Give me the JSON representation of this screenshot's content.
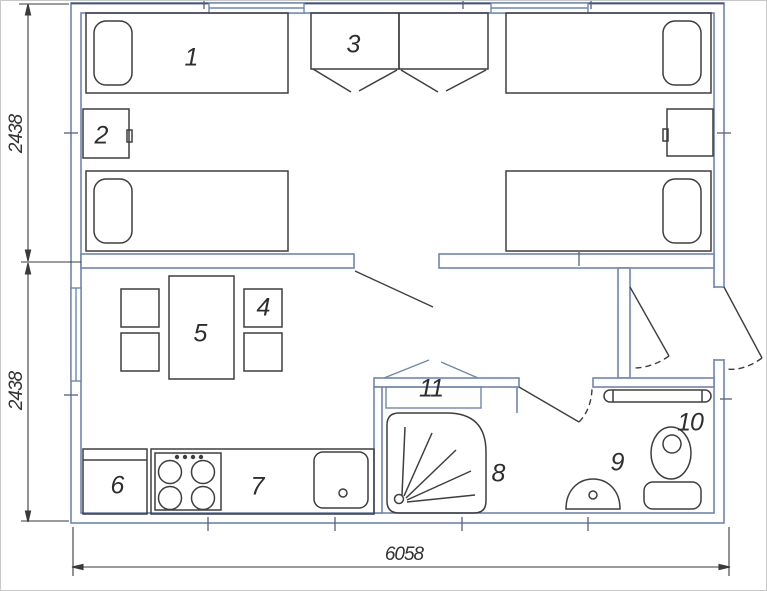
{
  "plan": {
    "title_hint": "floor-plan",
    "labels": [
      {
        "item": "bed",
        "text": "1"
      },
      {
        "item": "nightstand",
        "text": "2"
      },
      {
        "item": "wardrobe",
        "text": "3"
      },
      {
        "item": "chair",
        "text": "4"
      },
      {
        "item": "dining-table",
        "text": "5"
      },
      {
        "item": "fridge",
        "text": "6"
      },
      {
        "item": "kitchen-counter",
        "text": "7"
      },
      {
        "item": "shower-tray",
        "text": "8"
      },
      {
        "item": "washbasin",
        "text": "9"
      },
      {
        "item": "toilet",
        "text": "10"
      },
      {
        "item": "shelf-heater",
        "text": "11"
      }
    ],
    "dimensions": {
      "left_upper": "2438",
      "left_lower": "2438",
      "bottom_width": "6058"
    },
    "colors": {
      "wall": "#6e86b2",
      "wall_dark": "#45536e",
      "furniture": "#3e3e3e",
      "dimension": "#3a3a3a"
    }
  }
}
